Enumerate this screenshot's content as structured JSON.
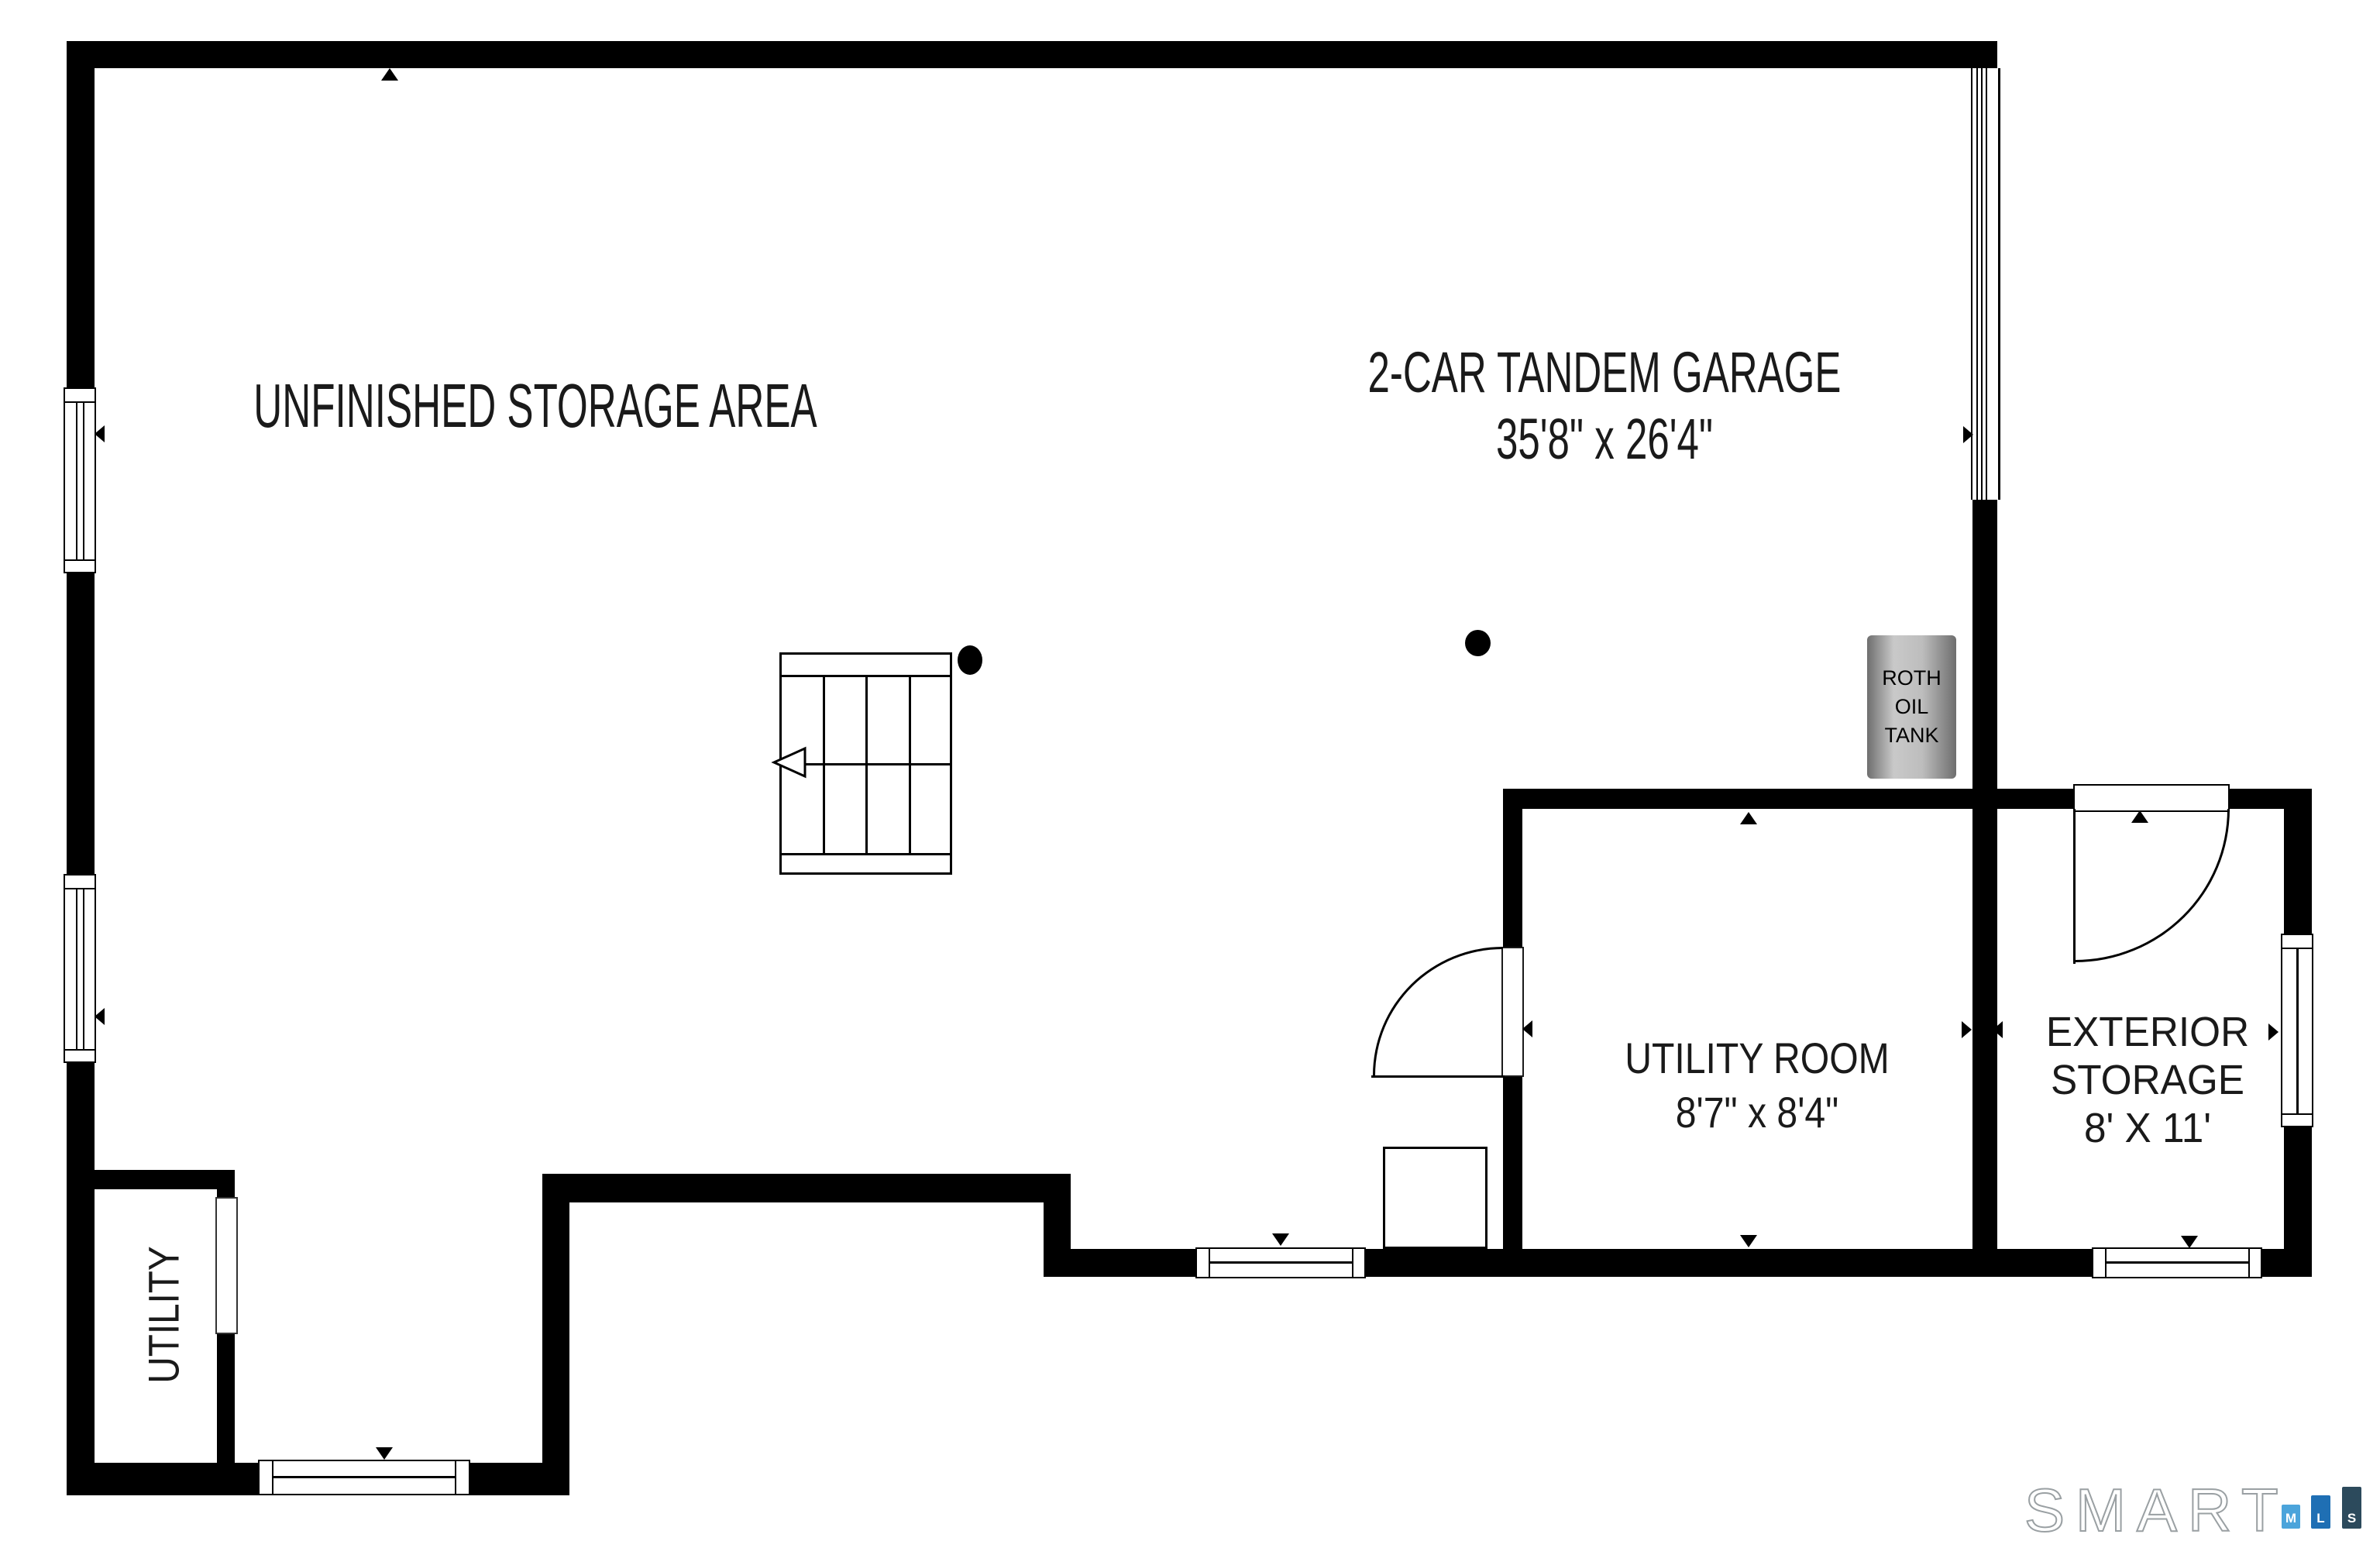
{
  "plan": {
    "rooms": {
      "unfinished_storage": {
        "label": "UNFINISHED STORAGE AREA"
      },
      "garage": {
        "label": "2-CAR TANDEM GARAGE",
        "dimensions": "35'8\" x 26'4\""
      },
      "utility_room": {
        "label": "UTILITY ROOM",
        "dimensions": "8'7\" x 8'4\""
      },
      "exterior_storage": {
        "label_line1": "EXTERIOR",
        "label_line2": "STORAGE",
        "dimensions": "8' X 11'"
      },
      "utility_closet": {
        "label": "UTILITY"
      }
    },
    "equipment": {
      "oil_tank_line1": "ROTH",
      "oil_tank_line2": "OIL",
      "oil_tank_line3": "TANK"
    },
    "icons": {
      "entry_marker": "filled-triangle",
      "stairs_arrow": "open-left-arrow",
      "structural_column": "black-dot"
    }
  },
  "branding": {
    "logo_text": "SMART",
    "badge_m": "M",
    "badge_l": "L",
    "badge_s": "S"
  },
  "colors": {
    "wall": "#000000",
    "background": "#ffffff",
    "tank_gray": "#bdbdbd",
    "badge_m_blue": "#4BA4DB",
    "badge_l_blue": "#1F6FB4",
    "badge_s_slate": "#2C4A5C",
    "logo_outline": "#9aa0a3"
  }
}
